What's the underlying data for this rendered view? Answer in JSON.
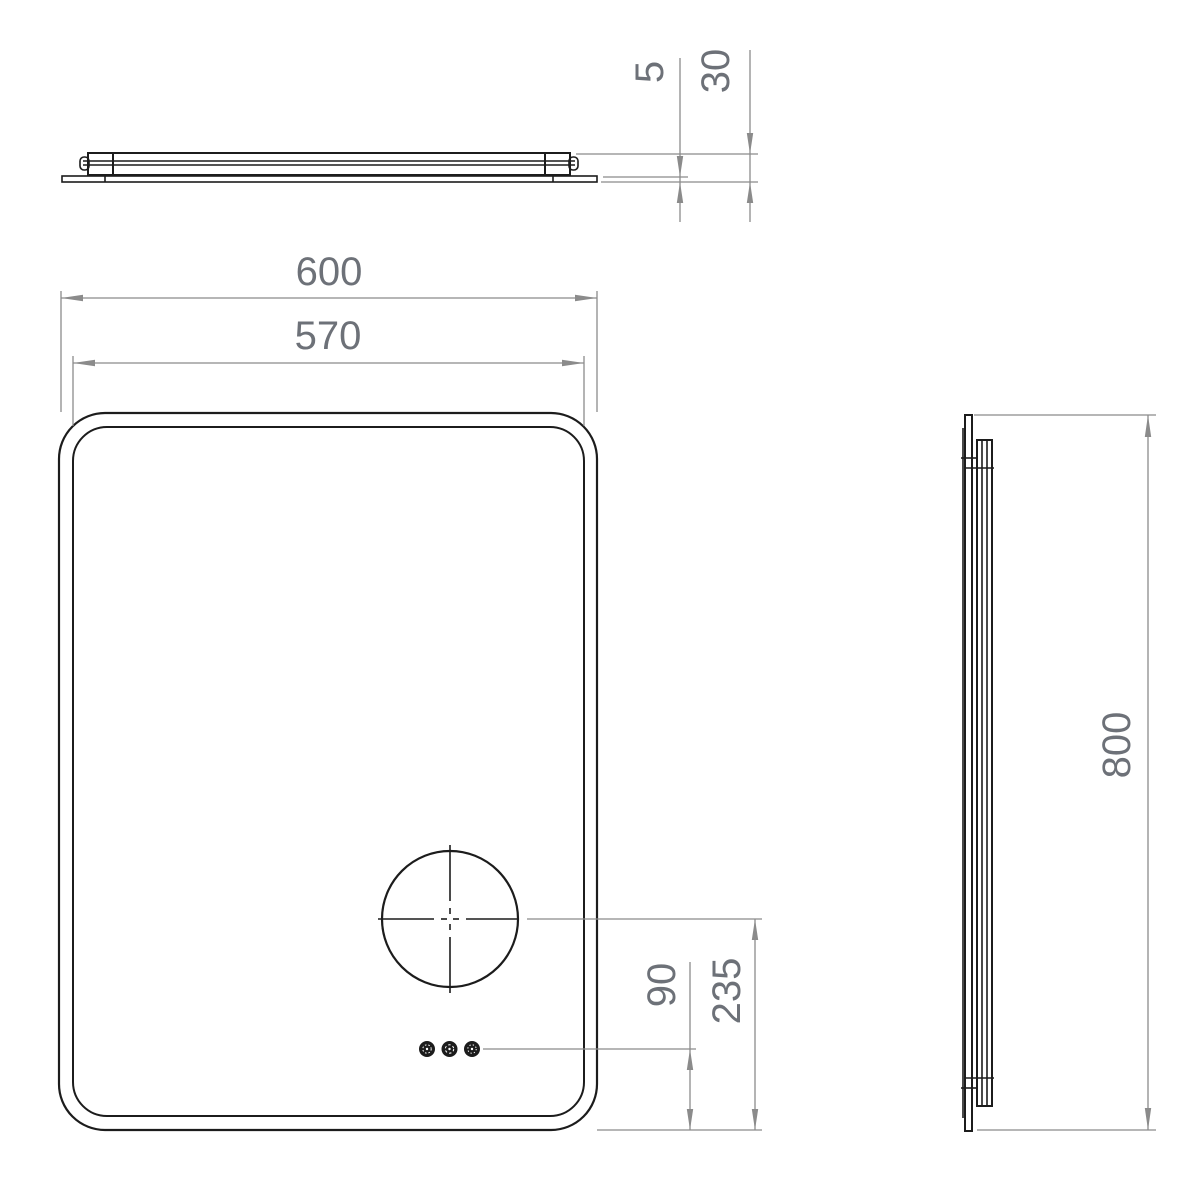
{
  "colors": {
    "line_color": "#1c1c1c",
    "dim_color": "#8b8b8b",
    "text_color": "#6d7178",
    "background": "#ffffff"
  },
  "dimensions": {
    "glass_thickness": "5",
    "overall_depth": "30",
    "overall_width": "600",
    "inner_width": "570",
    "overall_height": "800",
    "controls_to_bottom": "90",
    "magnifier_center_to_bottom": "235"
  }
}
